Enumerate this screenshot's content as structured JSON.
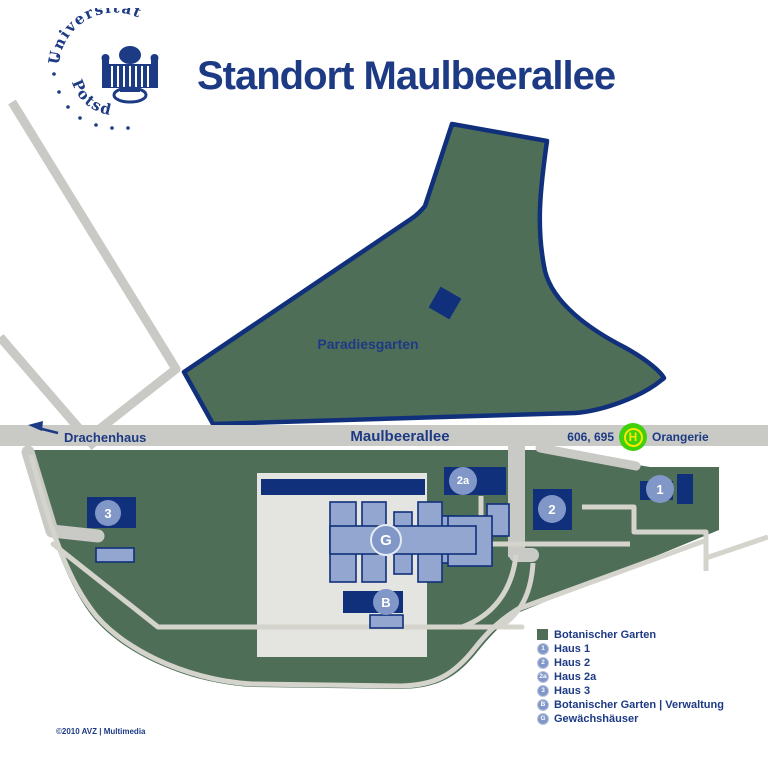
{
  "header": {
    "title": "Standort Maulbeerallee",
    "logo": {
      "arc_top": "Universität",
      "arc_bottom": "Potsdam"
    }
  },
  "map": {
    "road_labels": {
      "drachenhaus": "Drachenhaus",
      "maulbeerallee": "Maulbeerallee"
    },
    "bus_stop": {
      "lines": "606, 695",
      "name": "Orangerie",
      "symbol": "H"
    },
    "areas": {
      "paradiesgarten": "Paradiesgarten"
    },
    "badges": {
      "haus1": "1",
      "haus2": "2",
      "haus2a": "2a",
      "haus3": "3",
      "gewaechshaeuser": "G",
      "verwaltung": "B"
    }
  },
  "legend": {
    "items": [
      {
        "type": "square",
        "glyph": "",
        "label": "Botanischer Garten"
      },
      {
        "type": "badge",
        "glyph": "1",
        "label": "Haus 1"
      },
      {
        "type": "badge",
        "glyph": "2",
        "label": "Haus 2"
      },
      {
        "type": "badge",
        "glyph": "2a",
        "label": "Haus 2a"
      },
      {
        "type": "badge",
        "glyph": "3",
        "label": "Haus 3"
      },
      {
        "type": "badge",
        "glyph": "B",
        "label": "Botanischer Garten | Verwaltung"
      },
      {
        "type": "badge",
        "glyph": "G",
        "label": "Gewächshäuser"
      }
    ]
  },
  "footer": {
    "copyright": "©2010 AVZ | Multimedia"
  },
  "colors": {
    "navy": "#10307c",
    "textnavy": "#1d3a85",
    "green": "#4f6e58",
    "road": "#c9c9c5",
    "path": "#d4d4cd",
    "plot": "#e4e4e0",
    "steel": "#93a6d0",
    "badge": "#8097c7",
    "bus_green": "#3ed10c",
    "bus_yellow": "#ffe600"
  }
}
